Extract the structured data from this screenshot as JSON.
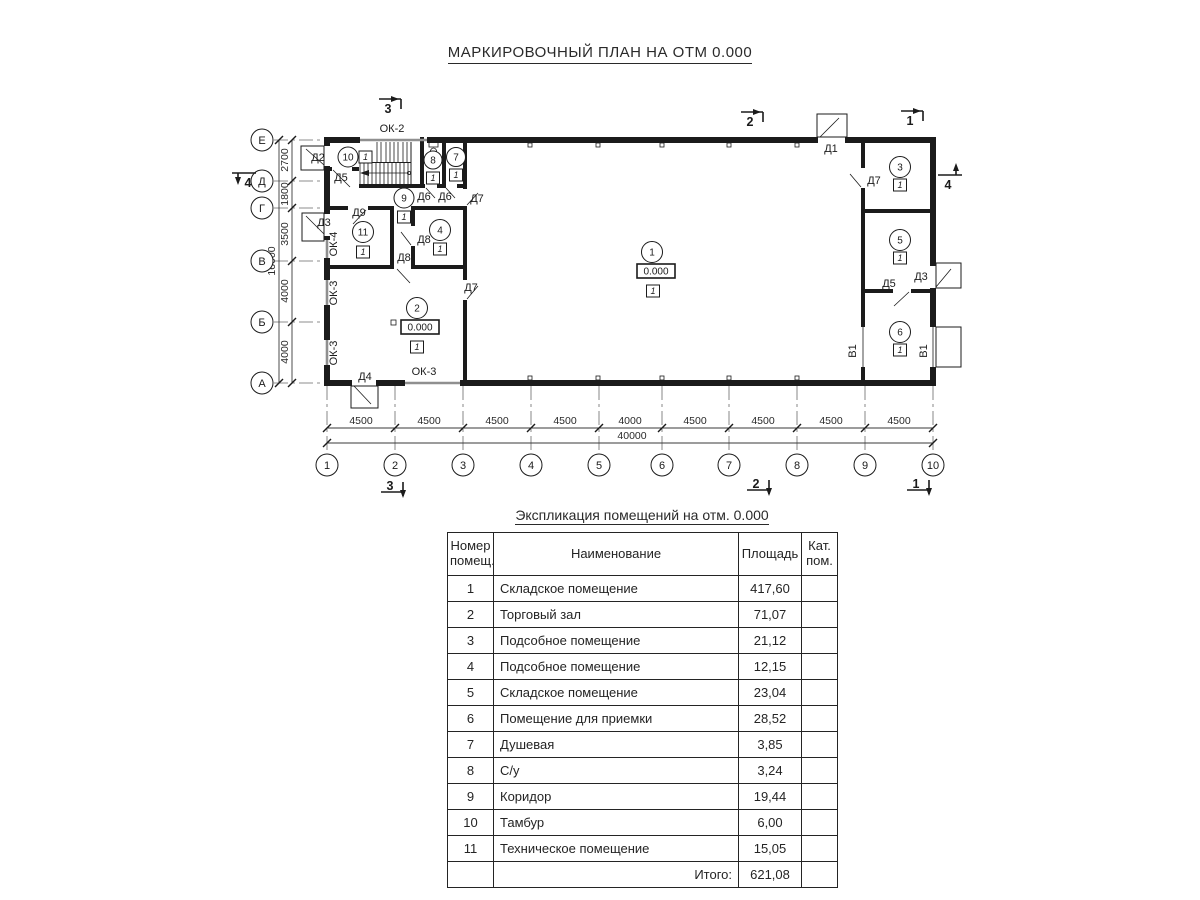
{
  "page": {
    "title": "МАРКИРОВОЧНЫЙ ПЛАН НА ОТМ 0.000"
  },
  "plan": {
    "axes_h": [
      "1",
      "2",
      "3",
      "4",
      "5",
      "6",
      "7",
      "8",
      "9",
      "10"
    ],
    "axes_v": [
      "Е",
      "Д",
      "Г",
      "В",
      "Б",
      "А"
    ],
    "dims_h": [
      "4500",
      "4500",
      "4500",
      "4500",
      "4000",
      "4500",
      "4500",
      "4500",
      "4500"
    ],
    "dims_h_total": "40000",
    "dims_v": [
      "2700",
      "1800",
      "3500",
      "4000",
      "4000"
    ],
    "dims_v_total": "16000",
    "sections": [
      "1",
      "2",
      "3",
      "4"
    ],
    "doors": {
      "d1": "Д1",
      "d2": "Д2",
      "d3": "Д3",
      "d4": "Д4",
      "d5": "Д5",
      "d6": "Д6",
      "d7": "Д7",
      "d8": "Д8",
      "d9": "Д9"
    },
    "windows": {
      "ok2": "ОК-2",
      "ok3": "ОК-3",
      "ok4": "ОК-4"
    },
    "gate": "В1",
    "rooms": [
      {
        "num": "1",
        "cat": "1",
        "elev": "0.000"
      },
      {
        "num": "2",
        "cat": "1",
        "elev": "0.000"
      },
      {
        "num": "3",
        "cat": "1"
      },
      {
        "num": "4",
        "cat": "1"
      },
      {
        "num": "5",
        "cat": "1"
      },
      {
        "num": "6",
        "cat": "1"
      },
      {
        "num": "7",
        "cat": "1"
      },
      {
        "num": "8",
        "cat": "1"
      },
      {
        "num": "9",
        "cat": "1"
      },
      {
        "num": "10",
        "cat": "1"
      },
      {
        "num": "11",
        "cat": "1"
      }
    ]
  },
  "table": {
    "title": "Экспликация помещений на отм. 0.000",
    "headers": {
      "num": "Номер помещ.",
      "name": "Наименование",
      "area": "Площадь",
      "cat": "Кат. пом."
    },
    "rows": [
      {
        "num": "1",
        "name": "Складское помещение",
        "area": "417,60"
      },
      {
        "num": "2",
        "name": "Торговый зал",
        "area": "71,07"
      },
      {
        "num": "3",
        "name": "Подсобное помещение",
        "area": "21,12"
      },
      {
        "num": "4",
        "name": "Подсобное помещение",
        "area": "12,15"
      },
      {
        "num": "5",
        "name": "Складское помещение",
        "area": "23,04"
      },
      {
        "num": "6",
        "name": "Помещение для приемки",
        "area": "28,52"
      },
      {
        "num": "7",
        "name": "Душевая",
        "area": "3,85"
      },
      {
        "num": "8",
        "name": "С/у",
        "area": "3,24"
      },
      {
        "num": "9",
        "name": "Коридор",
        "area": "19,44"
      },
      {
        "num": "10",
        "name": "Тамбур",
        "area": "6,00"
      },
      {
        "num": "11",
        "name": "Техническое помещение",
        "area": "15,05"
      }
    ],
    "total_label": "Итого:",
    "total_value": "621,08"
  }
}
